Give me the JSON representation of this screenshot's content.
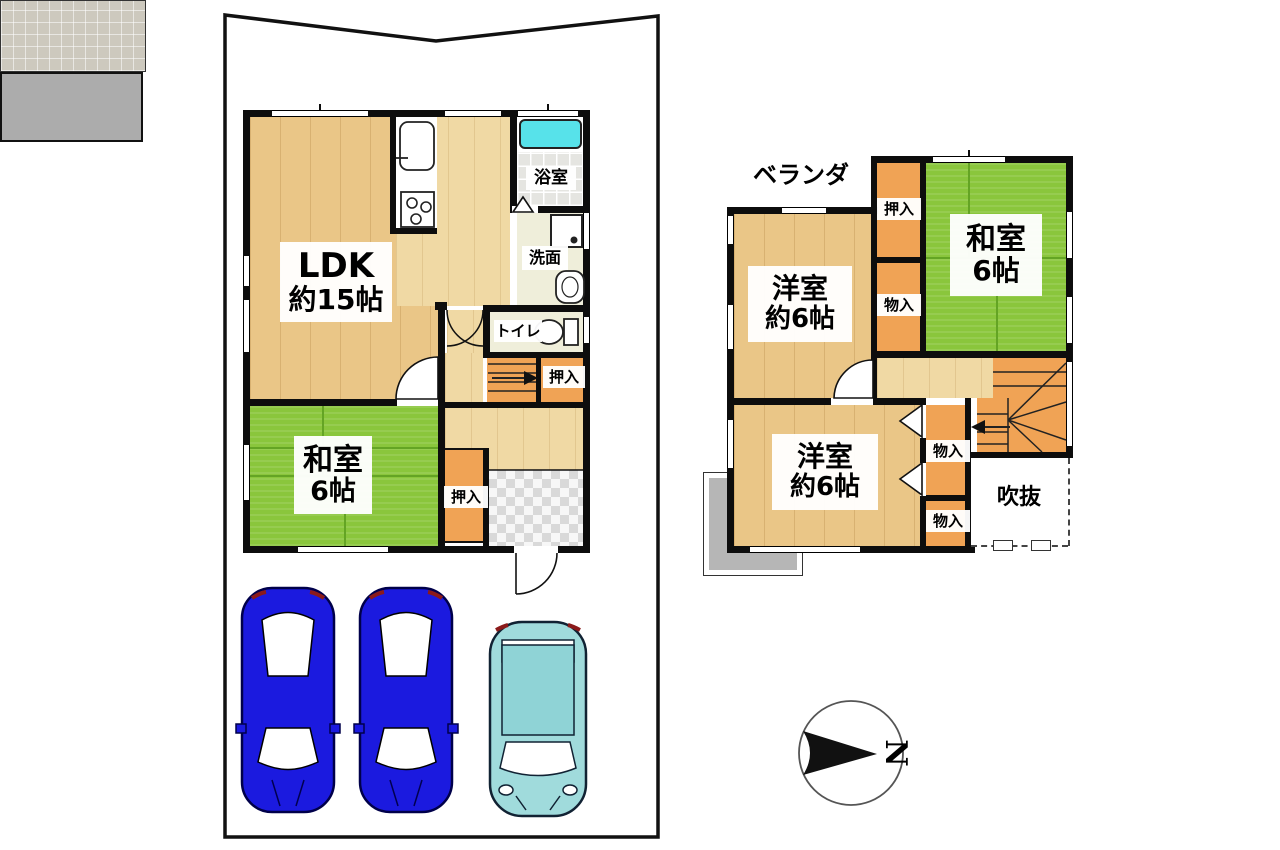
{
  "floor1": {
    "ldk": {
      "name": "LDK",
      "area": "約15帖"
    },
    "washitsu": {
      "name": "和室",
      "area": "6帖"
    },
    "bath": "浴室",
    "washroom": "洗面",
    "toilet": "トイレ",
    "closet_by_stairs": "押入",
    "closet_by_entry": "押入"
  },
  "floor2": {
    "veranda": "ベランダ",
    "western_upper": {
      "name": "洋室",
      "area": "約6帖"
    },
    "washitsu": {
      "name": "和室",
      "area": "6帖"
    },
    "western_lower": {
      "name": "洋室",
      "area": "約6帖"
    },
    "closet": "押入",
    "storage_upper": "物入",
    "storage_mid": "物入",
    "storage_lower": "物入",
    "void": "吹抜"
  },
  "compass": {
    "north": "N"
  },
  "colors": {
    "wood": "#EAC687",
    "wood_light": "#F0D9A4",
    "tatami_green": "#8AC63C",
    "closet_orange": "#F0A355",
    "bathtub_cyan": "#57E2EA",
    "car_blue": "#1B1ADF",
    "car_teal": "#A0DBDC",
    "veranda_gray": "#ACACAC",
    "porch_gray": "#CDC9BE"
  }
}
